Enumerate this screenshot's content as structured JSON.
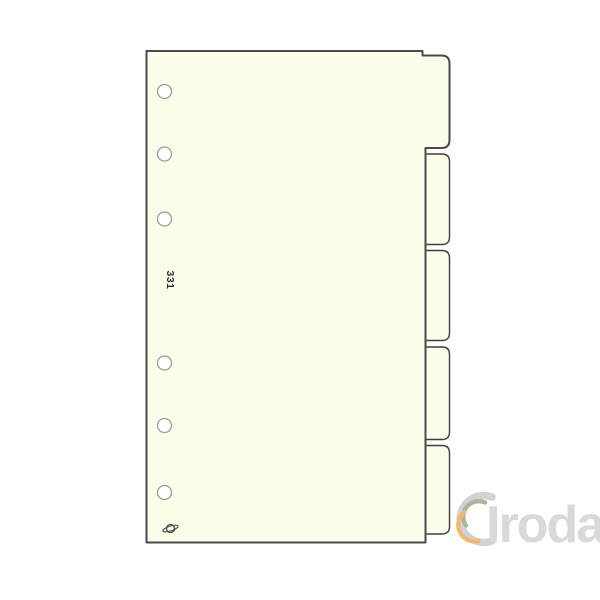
{
  "photo": {
    "description": "Cream blank index divider sheet with six punch holes and five side tabs",
    "product_code": "331",
    "tab_count": 5,
    "hole_count": 6,
    "colors": {
      "background": "#ffffff",
      "sheet_fill": "#fdfbe9",
      "sheet_border": "#4a4a4a",
      "tab_border": "#3e3e3e",
      "hole_fill": "#ffffff",
      "hole_stroke": "#9b9b9b",
      "code_text": "#2e2e2e",
      "emblem": "#4a4a4a"
    },
    "watermark": {
      "text": "Iroda",
      "text_color": "#d9d9d9",
      "crescent_outer": "#d2d2d2",
      "crescent_middle": "#aab79b",
      "crescent_inner": "#f3b76e"
    }
  }
}
